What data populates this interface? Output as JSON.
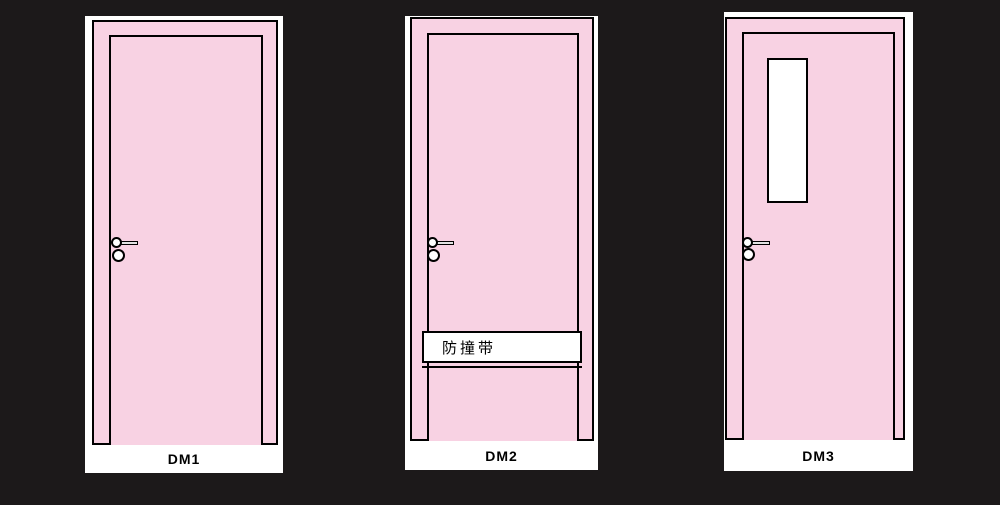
{
  "colors": {
    "background": "#1c191a",
    "door_fill": "#f8d2e3",
    "outline": "#000000",
    "panel_white": "#ffffff"
  },
  "doors": [
    {
      "label": "DM1",
      "features": [
        "lever-handle",
        "knob"
      ]
    },
    {
      "label": "DM2",
      "features": [
        "lever-handle",
        "knob",
        "bumper-strip"
      ],
      "bumper_text": "防撞带"
    },
    {
      "label": "DM3",
      "features": [
        "lever-handle",
        "knob",
        "vision-panel"
      ]
    }
  ]
}
